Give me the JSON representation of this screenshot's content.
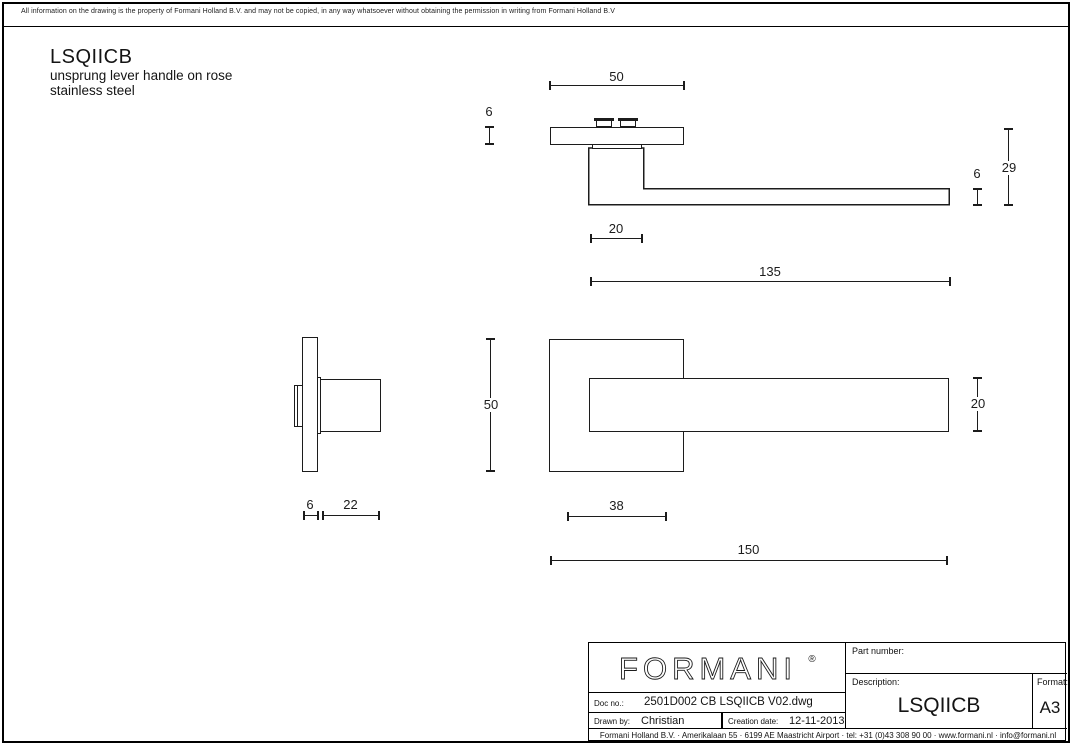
{
  "disclaimer": "All information on the drawing is the property of Formani Holland B.V. and may not be copied, in any way whatsoever without obtaining the permission in writing from Formani Holland B.V",
  "product": {
    "code": "LSQIICB",
    "subtitle_line1": "unsprung lever handle on rose",
    "subtitle_line2": "stainless steel"
  },
  "dims": {
    "top": {
      "rose_width": "50",
      "rose_thickness": "6",
      "lever_thickness": "6",
      "total_height": "29",
      "neck_width": "20",
      "lever_length": "135"
    },
    "front": {
      "rose_height": "50",
      "grip_height": "20",
      "neck_offset": "38",
      "total_length": "150"
    },
    "side": {
      "rose_thickness": "6",
      "grip_depth": "22"
    }
  },
  "title_block": {
    "logo": "FORMANI",
    "logo_reg": "®",
    "part_number_label": "Part number:",
    "part_number_value": "",
    "description_label": "Description:",
    "description_value": "LSQIICB",
    "format_label": "Format:",
    "format_value": "A3",
    "doc_no_label": "Doc no.:",
    "doc_no_value": "2501D002 CB LSQIICB V02.dwg",
    "drawn_by_label": "Drawn by:",
    "drawn_by_value": "Christian",
    "creation_date_label": "Creation date:",
    "creation_date_value": "12-11-2013",
    "footer": "Formani Holland B.V.  ·  Amerikalaan 55  ·  6199 AE Maastricht Airport  ·  tel: +31 (0)43 308 90 00  ·  www.formani.nl  ·  info@formani.nl"
  },
  "colors": {
    "line": "#1c1c1c",
    "background": "#ffffff"
  }
}
